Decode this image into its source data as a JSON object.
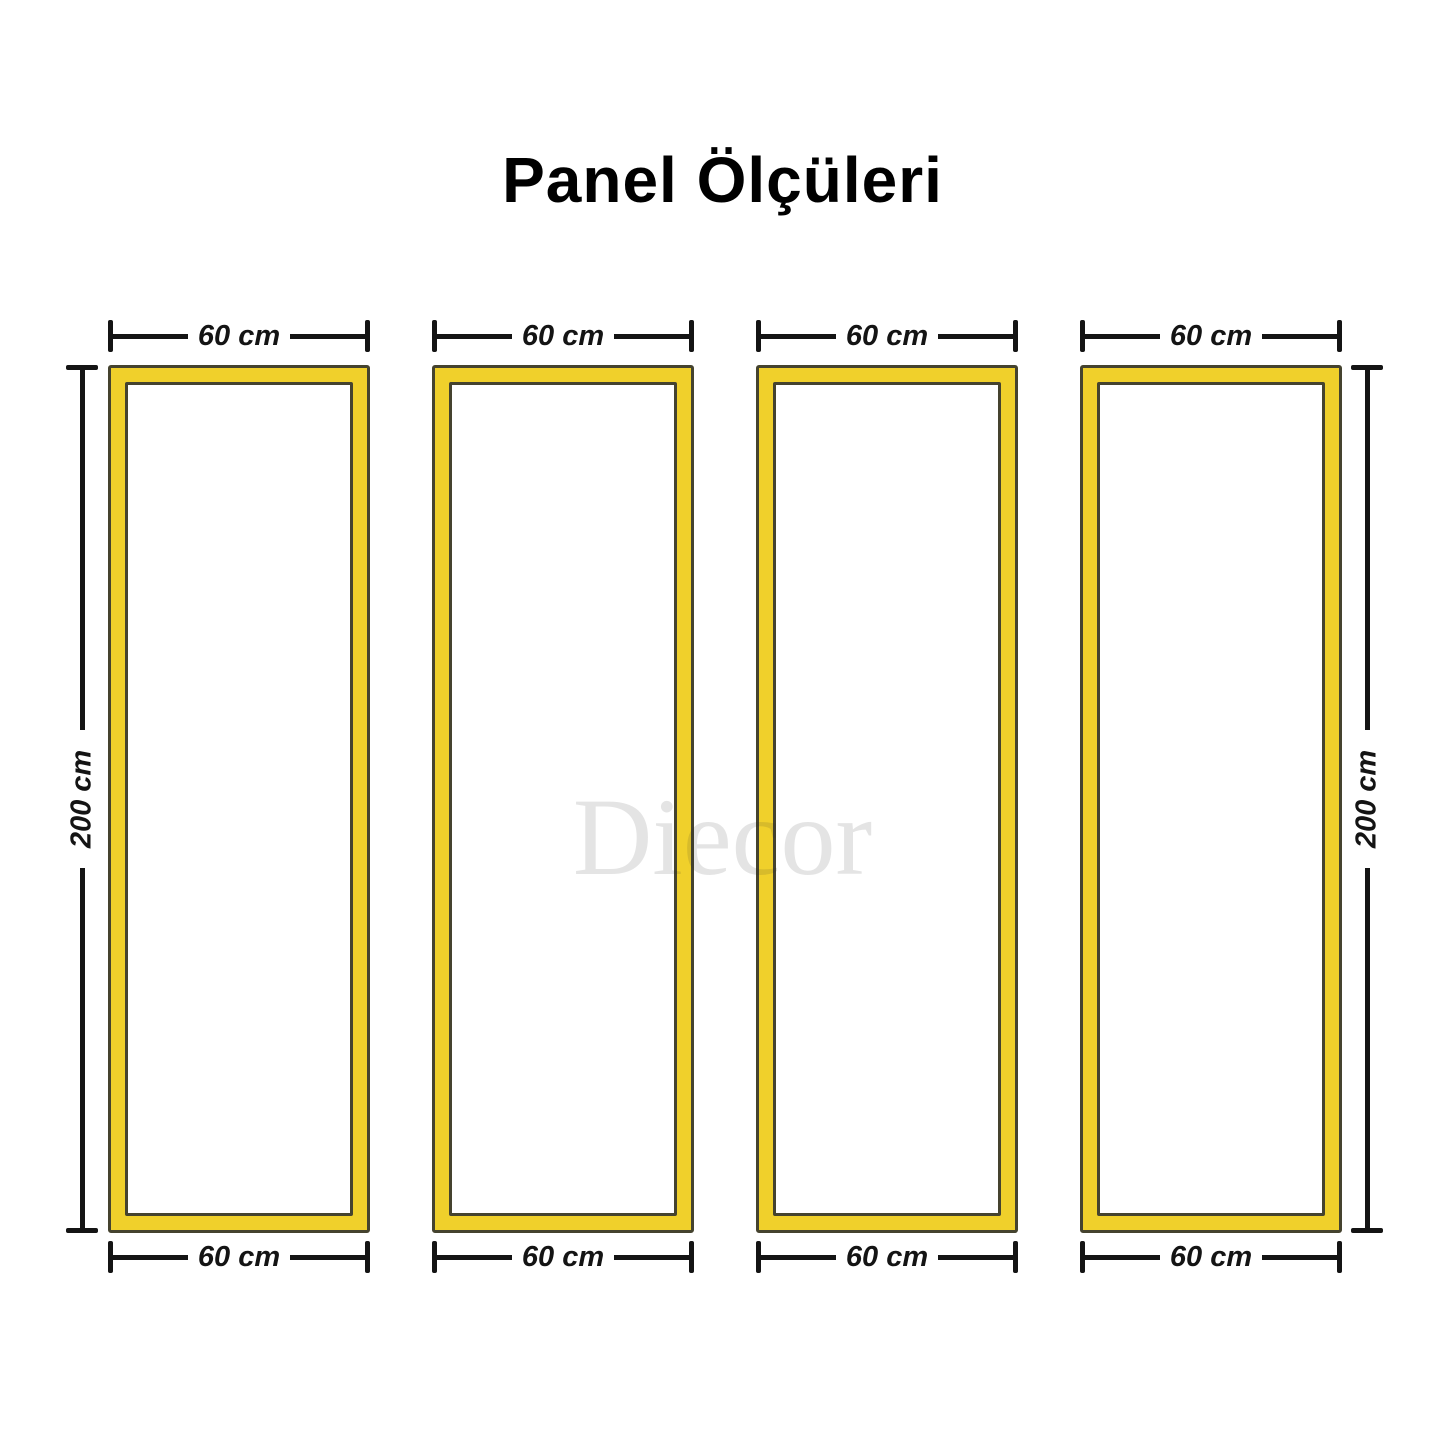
{
  "title": "Panel Ölçüleri",
  "watermark": "Diecor",
  "panels": [
    {
      "id": 1,
      "top_width_label": "60 cm",
      "bottom_width_label": "60 cm"
    },
    {
      "id": 2,
      "top_width_label": "60 cm",
      "bottom_width_label": "60 cm"
    },
    {
      "id": 3,
      "top_width_label": "60 cm",
      "bottom_width_label": "60 cm"
    },
    {
      "id": 4,
      "top_width_label": "60 cm",
      "bottom_width_label": "60 cm"
    }
  ],
  "height_dimensions": {
    "left_label": "200 cm",
    "right_label": "200 cm"
  },
  "panel_count": 4,
  "colors": {
    "panel_fill": "#F0D02B",
    "panel_outline": "#45432F",
    "dimension_ink": "#141414",
    "watermark_ink": "#E3E3E3",
    "background": "#FFFFFF"
  }
}
